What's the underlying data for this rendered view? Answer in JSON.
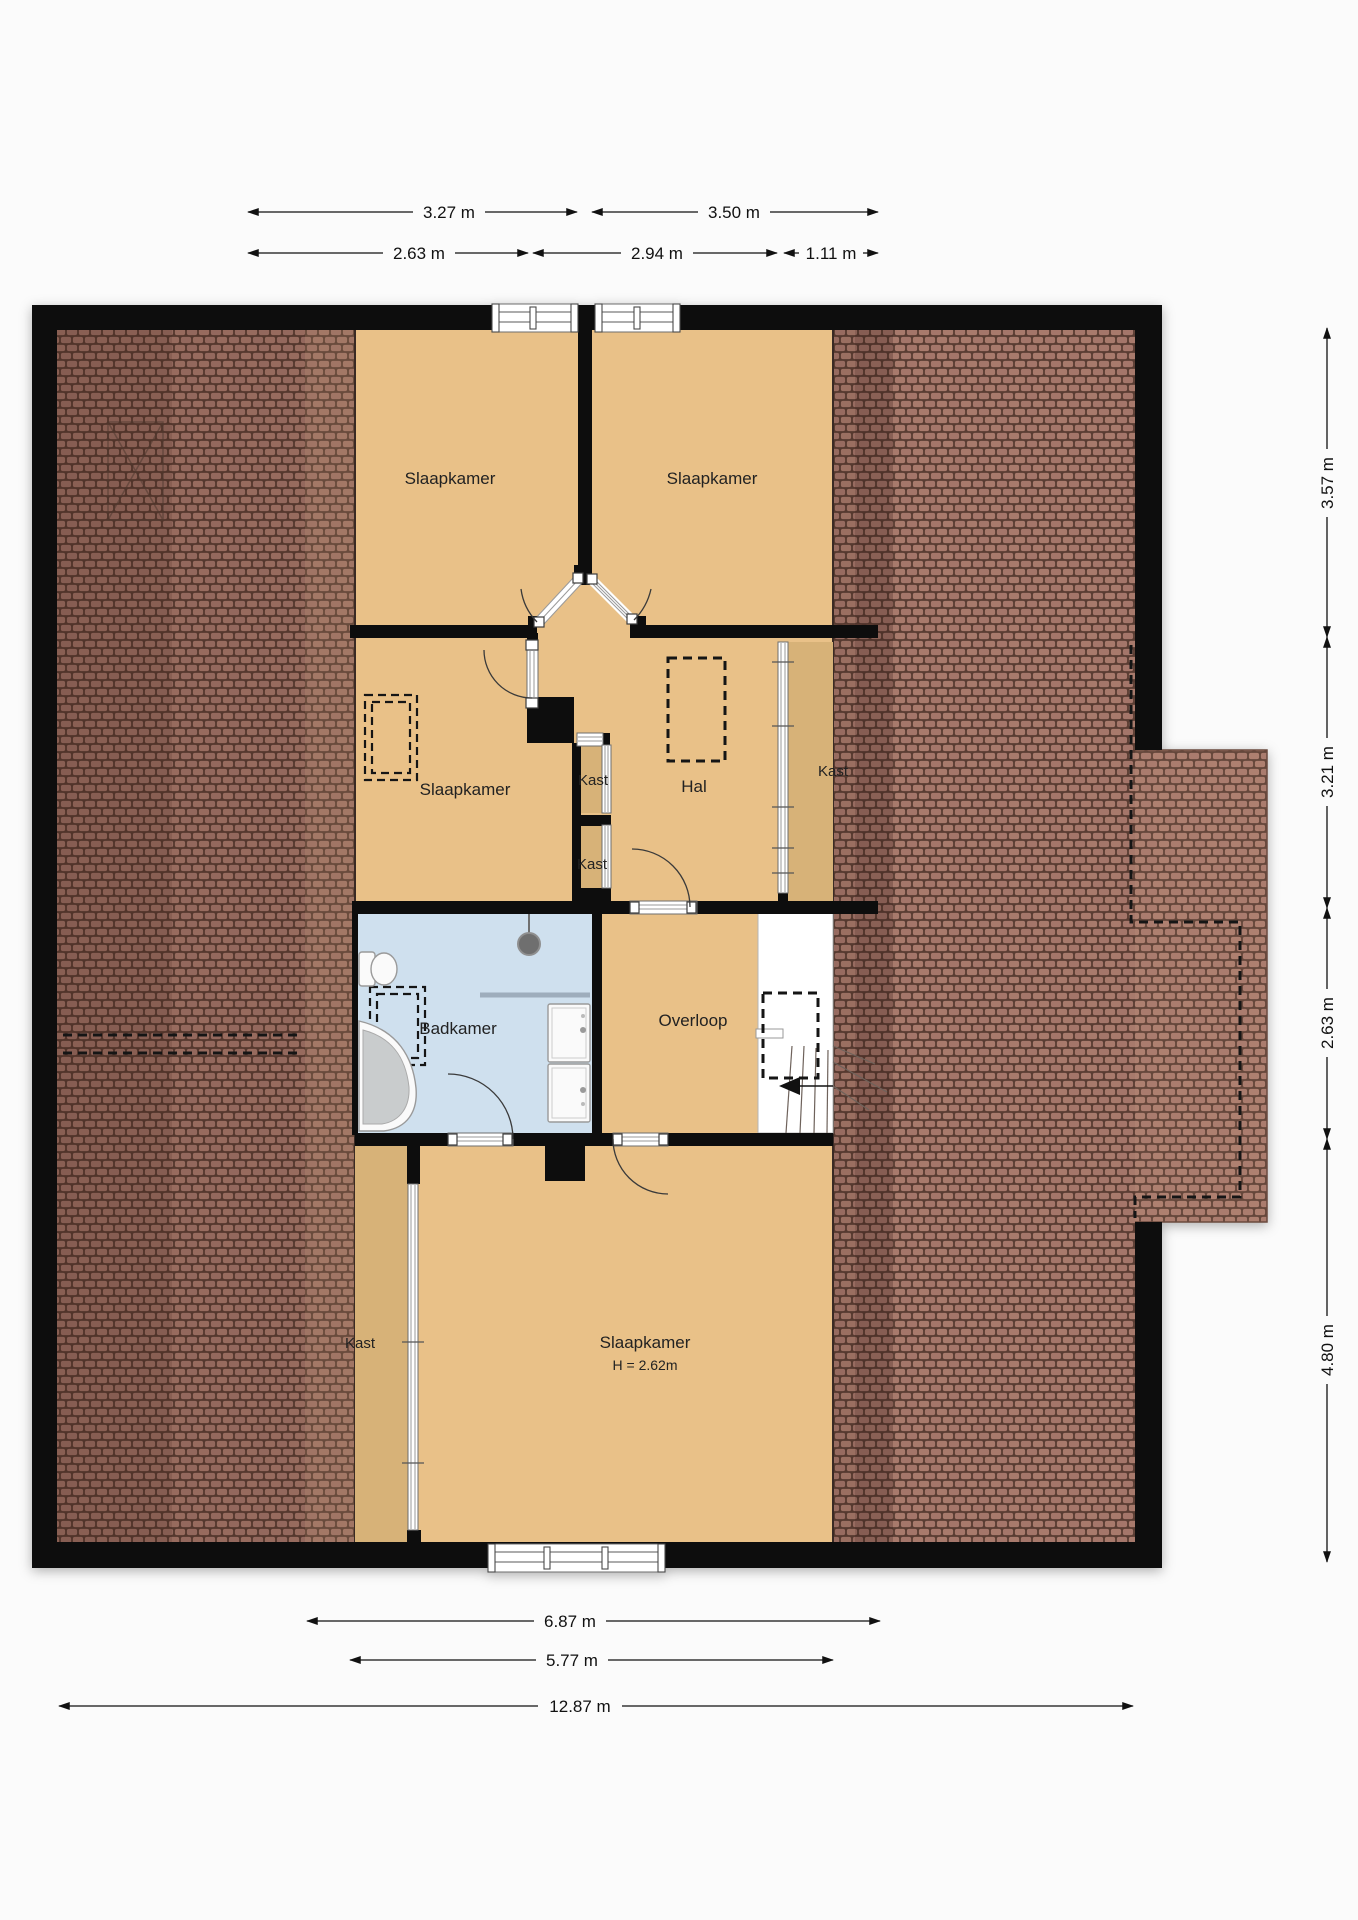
{
  "plan": {
    "title": "floor-plan-attic",
    "colors": {
      "page": "#fbfbfb",
      "wall": "#0d0d0d",
      "room": "#e9c188",
      "closet": "#d7b278",
      "bathroom": "#cfe0ee",
      "tile_base": "#a2756a",
      "tile_face": "#a87a6c",
      "tile_gap": "#5a3d33",
      "stairs": "#ffffff"
    },
    "rooms": {
      "bedroom_top_left": {
        "label": "Slaapkamer"
      },
      "bedroom_top_right": {
        "label": "Slaapkamer"
      },
      "bedroom_mid_left": {
        "label": "Slaapkamer"
      },
      "hall": {
        "label": "Hal"
      },
      "closet_hall_upper": {
        "label": "Kast"
      },
      "closet_hall_lower": {
        "label": "Kast"
      },
      "closet_right": {
        "label": "Kast"
      },
      "bathroom": {
        "label": "Badkamer"
      },
      "landing": {
        "label": "Overloop"
      },
      "bedroom_bottom": {
        "label": "Slaapkamer",
        "height_note": "H = 2.62m"
      },
      "closet_bottom_left": {
        "label": "Kast"
      }
    },
    "dimensions": {
      "top_upper": [
        {
          "label": "3.27 m"
        },
        {
          "label": "3.50 m"
        }
      ],
      "top_lower": [
        {
          "label": "2.63 m"
        },
        {
          "label": "2.94 m"
        },
        {
          "label": "1.11 m"
        }
      ],
      "right_side": [
        {
          "label": "3.57 m"
        },
        {
          "label": "3.21 m"
        },
        {
          "label": "2.63 m"
        },
        {
          "label": "4.80 m"
        }
      ],
      "bottom": [
        {
          "label": "6.87 m"
        },
        {
          "label": "5.77 m"
        },
        {
          "label": "12.87 m"
        }
      ]
    }
  }
}
